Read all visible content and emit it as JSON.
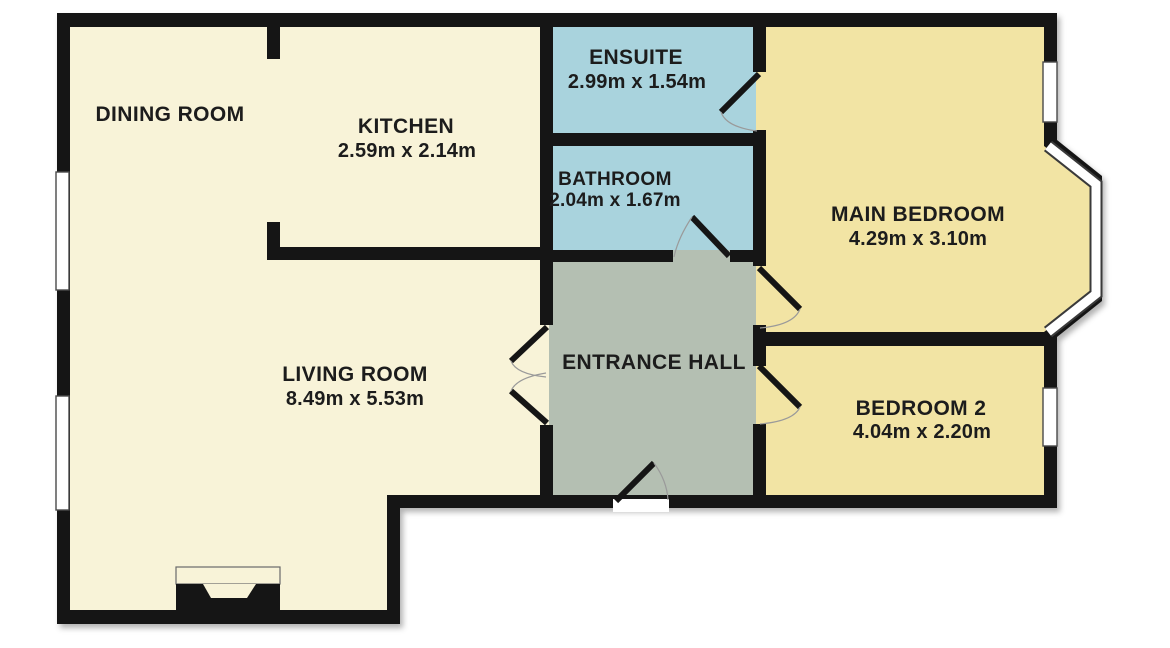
{
  "colors": {
    "wall": "#151515",
    "floor_living": "#f8f3d8",
    "floor_wet": "#a9d3dd",
    "floor_bedroom": "#f2e4a4",
    "floor_hall": "#b4bfb2",
    "window": "#ffffff",
    "label": "#1c1c1c"
  },
  "rooms": [
    {
      "name": "DINING ROOM",
      "dims": ""
    },
    {
      "name": "KITCHEN",
      "dims": "2.59m x 2.14m"
    },
    {
      "name": "ENSUITE",
      "dims": "2.99m x 1.54m"
    },
    {
      "name": "BATHROOM",
      "dims": "2.04m x 1.67m"
    },
    {
      "name": "MAIN BEDROOM",
      "dims": "4.29m x 3.10m"
    },
    {
      "name": "ENTRANCE HALL",
      "dims": ""
    },
    {
      "name": "LIVING ROOM",
      "dims": "8.49m x 5.53m"
    },
    {
      "name": "BEDROOM 2",
      "dims": "4.04m x 2.20m"
    }
  ]
}
